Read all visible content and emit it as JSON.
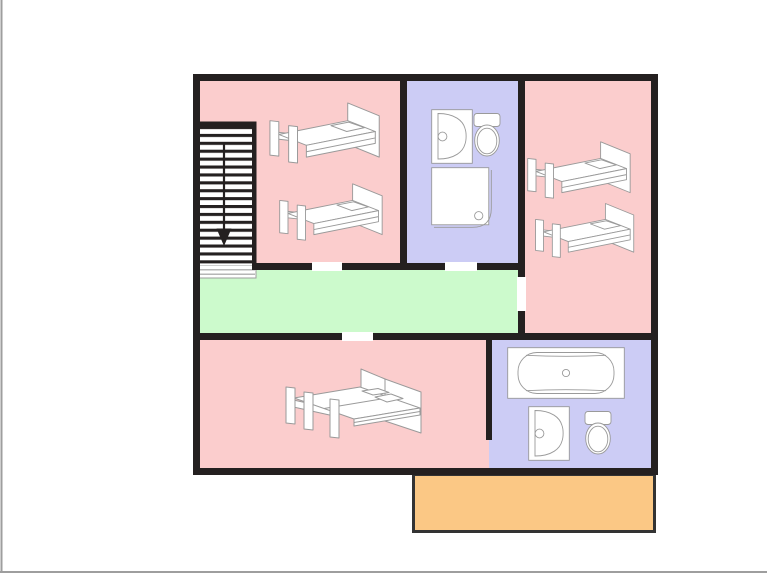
{
  "diagram": {
    "type": "floor-plan",
    "rooms": [
      {
        "id": "bedroom-top-left",
        "type": "bedroom",
        "furniture": [
          "single bed",
          "single bed"
        ]
      },
      {
        "id": "bathroom-top",
        "type": "bathroom",
        "furniture": [
          "sink",
          "toilet",
          "shower"
        ]
      },
      {
        "id": "bedroom-top-right",
        "type": "bedroom",
        "furniture": [
          "single bed",
          "single bed"
        ]
      },
      {
        "id": "hallway",
        "type": "hallway",
        "furniture": []
      },
      {
        "id": "bedroom-bottom",
        "type": "bedroom",
        "furniture": [
          "double bed"
        ]
      },
      {
        "id": "bathroom-bottom",
        "type": "bathroom",
        "furniture": [
          "bathtub",
          "sink",
          "toilet"
        ]
      },
      {
        "id": "balcony",
        "type": "balcony",
        "furniture": []
      }
    ],
    "doors": [
      {
        "between": [
          "bedroom-top-left",
          "hallway"
        ]
      },
      {
        "between": [
          "bathroom-top",
          "hallway"
        ]
      },
      {
        "between": [
          "bedroom-top-right",
          "hallway"
        ]
      },
      {
        "between": [
          "bedroom-bottom",
          "hallway"
        ]
      },
      {
        "between": [
          "bedroom-bottom",
          "bathroom-bottom"
        ]
      }
    ],
    "stairs": {
      "location": "top-left",
      "arrow_direction": "down",
      "tread_count": 18
    }
  },
  "palette": {
    "bedroom_fill": "#FBCDCD",
    "bathroom_fill": "#CCCCF5",
    "hallway_fill": "#CCFACC",
    "balcony_fill": "#FBC885",
    "balcony_outline": "#333333",
    "wall_color": "#242020",
    "stair_tread_color": "#242020",
    "door_gap_color": "#ffffff",
    "fixture_fill": "#ffffff",
    "fixture_outline": "#9a9a9a",
    "frame_border": "#9e9e9e",
    "background": "#ffffff"
  }
}
